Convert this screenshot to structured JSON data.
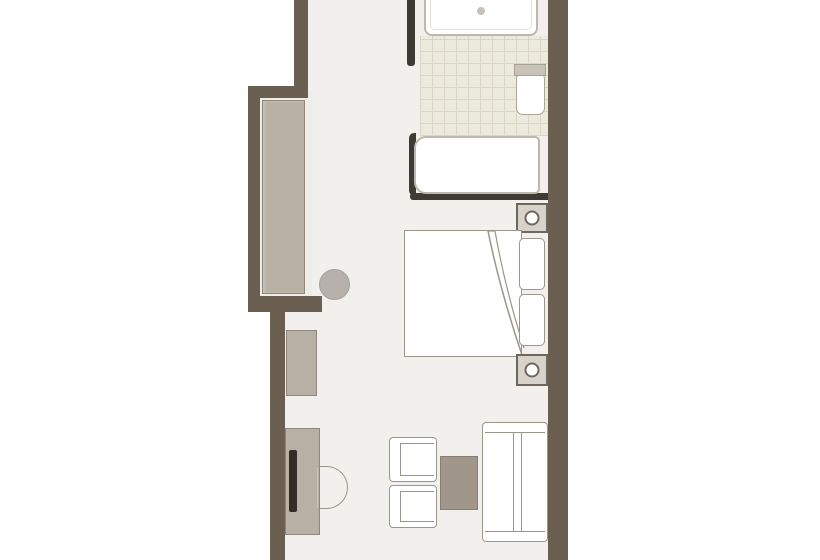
{
  "scene": {
    "name": "hotel-room-floor-plan",
    "rooms": [
      "bathroom",
      "corridor",
      "bedroom",
      "living-area"
    ]
  },
  "colors": {
    "outside": "#ffffff",
    "wall": "#6a5f51",
    "wall_dark": "#3f3a33",
    "floor": "#f2f0ec",
    "alcove_floor": "#efede8",
    "tile": "#eceadd",
    "tile_line": "#d9d6c6",
    "outline": "#9b968c",
    "fixture_outline": "#bdb8ad",
    "cabinet": "#b7b0a4",
    "cabinet_border": "#8f8779",
    "desk_panel": "#322d27",
    "table": "#a0968a",
    "table_border": "#897e70",
    "stool": "#b6b2ab",
    "nightstand": "#d7d3ca",
    "nightstand_border": "#6f675c",
    "toilet_tank": "#c9c3b7"
  },
  "elements": {
    "plan": "floor-plan",
    "floor": "room-floor",
    "alcove_floor": "closet-alcove-floor",
    "tiles": "bathroom-floor-tiles",
    "wall": "wall",
    "wall_stub": "bathroom-partition-wall",
    "divider": "bathroom-bedroom-divider",
    "tub_rim": "bathtub-rim",
    "shower": "shower-tray",
    "drain": "shower-drain",
    "toilet": "toilet",
    "toilet_tank": "toilet-cistern",
    "bathtub": "bathtub",
    "nightstand": "nightstand",
    "lamp": "bedside-lamp",
    "bed": "double-bed",
    "bed_fold": "duvet-fold",
    "pillow": "pillow",
    "wardrobe": "wardrobe",
    "stool": "stool",
    "minibar": "minibar-cabinet",
    "desk": "desk",
    "tv": "tv-panel",
    "desk_chair": "desk-chair",
    "armchair": "armchair",
    "coffee_table": "coffee-table",
    "sofa": "sofa"
  }
}
